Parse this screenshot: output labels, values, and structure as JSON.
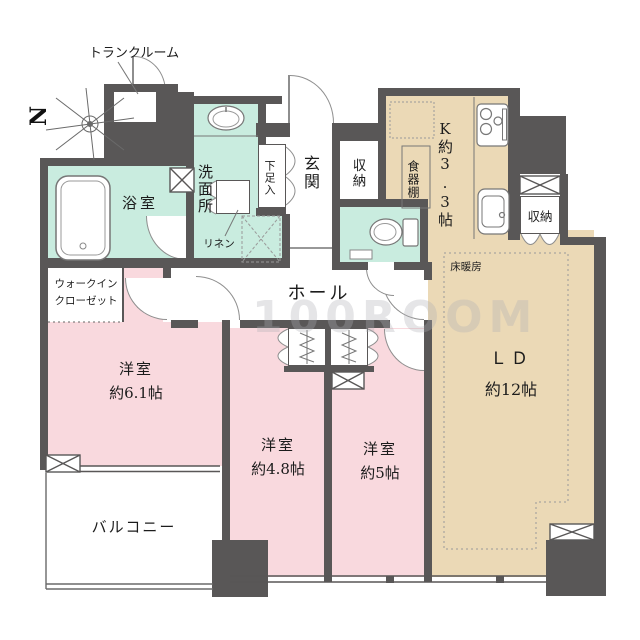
{
  "watermark": "100ROOM",
  "compass": {
    "north": "N"
  },
  "labels": {
    "trunk_room": "トランクルーム",
    "bathroom": "浴室",
    "washroom": "洗面所",
    "linen": "リネン",
    "shoe_cabinet": "下足入",
    "entrance": "玄関",
    "entrance_storage": "収納",
    "cupboard": "食器棚",
    "kitchen": "K約3.3帖",
    "kitchen_storage": "収納",
    "floor_heating": "床暖房",
    "hall": "ホール",
    "wic_line1": "ウォークイン",
    "wic_line2": "クローゼット",
    "bedroom1_name": "洋室",
    "bedroom1_size": "約6.1帖",
    "bedroom2_name": "洋室",
    "bedroom2_size": "約4.8帖",
    "bedroom3_name": "洋室",
    "bedroom3_size": "約5帖",
    "living_name": "ＬＤ",
    "living_size": "約12帖",
    "balcony": "バルコニー"
  },
  "colors": {
    "wall": "#595757",
    "bedroom_pink": "#f9d9de",
    "wet_area_mint": "#c9ecdf",
    "ldk_beige": "#ebd9b6",
    "line": "#8e8e8e"
  }
}
